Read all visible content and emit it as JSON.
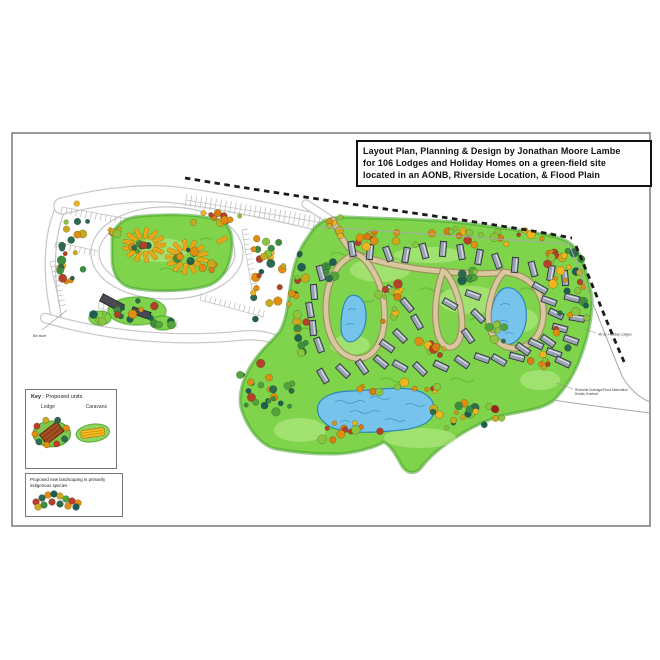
{
  "title_block": {
    "line1": "Layout Plan, Planning & Design by Jonathan Moore Lambe",
    "line2": "for 106 Lodges and Holiday Homes on a green-field site",
    "line3": "located in an AONB, Riverside Location, & Flood Plain"
  },
  "legend": {
    "key_word": "Key",
    "units_title": " : Proposed units",
    "lodge_label": "Lodge",
    "caravans_label": "Caravans",
    "landscaping_line1": "Proposed new landscaping in primarily",
    "landscaping_line2": "indigenous species"
  },
  "annotations": [
    {
      "name": "holiday-lodges-count-note",
      "text": "46 no. Holiday Lodges",
      "x": 598,
      "y": 335.5,
      "fs": 3.4,
      "leader": [
        584,
        329,
        596,
        333
      ]
    },
    {
      "name": "drainage-note",
      "text": "Riverside Drainage/Flood Attenuation",
      "text2": "Details Overleaf",
      "x": 575,
      "y": 391,
      "fs": 3.2,
      "leader": [
        556,
        383,
        573,
        389
      ]
    },
    {
      "name": "bin-store-note",
      "text": "Bin store",
      "x": 33,
      "y": 337,
      "fs": 3.4,
      "leader": [
        67,
        310,
        42,
        330
      ]
    }
  ],
  "colors": {
    "green_base": "#7fd44c",
    "green_edge": "#46a22c",
    "green_light": "#bdeb8e",
    "squiggle": "#4ea32d",
    "pond_fill": "#76c4ec",
    "pond_edge": "#2e86b8",
    "wave": "#3f98cc",
    "road_tan": "#d8c79f",
    "road_tan_edge": "#a08b62",
    "road_white_edge": "#c6c6c6",
    "lodge_fill": "#99a2b0",
    "lodge_edge": "#30343c",
    "lodge_ridge": "#e8edf4",
    "caravan_fill": "#f2c11d",
    "caravan_edge": "#b67a16",
    "caravan_stripe": "#d88f15",
    "building": "#4a4a52",
    "dash": "#1c1c1c",
    "thin": "#a8a8a8",
    "tree_stroke": "rgba(35,50,10,0.45)",
    "note_text": "#3a3a3a",
    "leader": "#999999",
    "sheet_border": "#7a7a7a"
  },
  "palettes": {
    "mixed": [
      "#e08e12",
      "#f0b41c",
      "#8bc53f",
      "#3e8e41",
      "#2d6a4f",
      "#b5402a",
      "#caa91f",
      "#1f5e52"
    ],
    "warm": [
      "#e08e12",
      "#f0b41c",
      "#d97b12",
      "#b5402a",
      "#caa91f",
      "#8bc53f",
      "#e08e12"
    ],
    "greens": [
      "#3e8e41",
      "#2d6a4f",
      "#52a33c",
      "#8bc53f",
      "#1f5e52"
    ],
    "dark": [
      "#2d6a4f",
      "#1f5e52",
      "#3e8e41",
      "#b5402a",
      "#e08e12",
      "#52a33c"
    ]
  },
  "map": {
    "sheet": {
      "x": 12,
      "y": 133,
      "w": 638,
      "h": 393
    },
    "white_roads": [
      {
        "d": "M95,253 C95,229 127,211 167,211 C207,211 239,229 239,253 C239,277 207,295 167,295 C127,295 95,277 95,253 Z",
        "w": 7
      },
      {
        "d": "M56,315 C46,270 50,228 62,206",
        "w": 9
      },
      {
        "d": "M62,206 C110,194 150,192 176,195 C230,202 285,214 334,226",
        "w": 15
      },
      {
        "d": "M45,318 C95,333 165,343 238,336 C268,332 288,343 298,357",
        "w": 8
      },
      {
        "d": "M306,204 C315,210 325,216 333,222",
        "w": 7
      }
    ],
    "parking_rows": [
      {
        "x1": 186,
        "y1": 200,
        "x2": 330,
        "y2": 224,
        "len": 6,
        "step": 5,
        "side": 0
      },
      {
        "x1": 62,
        "y1": 207,
        "x2": 146,
        "y2": 222,
        "len": 6.5,
        "step": 5,
        "side": 1
      },
      {
        "x1": 56,
        "y1": 242,
        "x2": 98,
        "y2": 251,
        "len": 6,
        "step": 5,
        "side": 1
      },
      {
        "x1": 50,
        "y1": 262,
        "x2": 60,
        "y2": 306,
        "len": 6,
        "step": 5,
        "side": -1
      },
      {
        "x1": 98,
        "y1": 308,
        "x2": 178,
        "y2": 327,
        "len": 6.5,
        "step": 5,
        "side": -1
      },
      {
        "x1": 200,
        "y1": 300,
        "x2": 264,
        "y2": 317,
        "len": 6.5,
        "step": 5,
        "side": -1
      },
      {
        "x1": 242,
        "y1": 230,
        "x2": 252,
        "y2": 290,
        "len": 6,
        "step": 5,
        "side": -1
      }
    ],
    "site_blob": "M312,231 C318,222 330,217 345,217 C390,219 440,219 480,225 C515,230 545,233 562,239 C572,242 580,252 584,266 C589,282 592,294 592,301 C592,316 589,334 581,356 C574,376 563,391 553,401 C540,410 522,411 505,415 C488,419 470,428 455,438 C445,445 432,453 420,469 C415,474 407,474 402,466 C397,457 392,447 384,442 C374,448 352,454 333,454 C315,454 298,453 276,449 C262,446 249,431 242,411 C237,396 243,378 252,364 C262,348 273,341 280,331 C287,319 288,301 291,282 C294,263 300,248 306,240 Z",
    "caravan_blob": "M112,240 C112,226 124,217 142,216 C165,214 195,214 215,219 C228,222 233,232 232,245 C231,262 226,278 210,285 C190,292 150,292 132,288 C118,285 112,272 112,258 Z",
    "patches_green": [
      [
        137,
        311,
        29,
        14
      ],
      [
        100,
        318,
        11,
        7
      ],
      [
        163,
        323,
        12,
        7
      ]
    ],
    "patches_light": [
      [
        380,
        270,
        30,
        12
      ],
      [
        470,
        300,
        32,
        14
      ],
      [
        350,
        345,
        20,
        10
      ],
      [
        520,
        320,
        18,
        12
      ],
      [
        420,
        438,
        36,
        10
      ],
      [
        300,
        430,
        26,
        12
      ],
      [
        430,
        255,
        36,
        8
      ],
      [
        160,
        250,
        28,
        12
      ],
      [
        540,
        380,
        20,
        10
      ]
    ],
    "squiggles": [
      "M330,255 q7,-5 14,0 t14,0",
      "M350,300 q6,-4 12,0 t12,0",
      "M420,290 q6,-4 12,0 t12,0",
      "M470,320 q6,-4 12,0 t12,0",
      "M520,290 q6,-4 12,0 t12,0",
      "M380,380 q6,-4 12,0 t12,0",
      "M450,380 q6,-4 12,0 t12,0",
      "M300,330 q5,-4 10,0 t10,0",
      "M130,235 q6,-4 12,0 t12,0",
      "M160,270 q6,-4 12,0 t12,0",
      "M200,240 q6,-4 12,0",
      "M330,430 q6,-4 12,0 t12,0",
      "M490,360 q6,-4 12,0"
    ],
    "ponds": [
      "M350,296 C358,293 365,300 366,312 C367,325 362,337 354,341 C347,344 341,338 341,327 C341,315 343,300 350,296 Z",
      "M505,288 C515,286 524,295 526,309 C528,325 522,340 511,344 C501,347 492,339 491,324 C490,309 495,291 505,288 Z",
      "M318,405 C322,396 335,391 352,391 C375,390 400,386 415,390 C428,393 436,402 434,412 C432,422 420,428 402,430 C382,432 358,434 340,430 C326,427 315,417 318,405 Z"
    ],
    "waves": [
      "M335,402 q5,-3 10,0 q5,3 10,0 q5,-3 10,0",
      "M350,412 q5,-3 10,0 q5,3 10,0 q5,-3 10,0",
      "M370,398 q5,-3 10,0 q5,3 10,0",
      "M385,420 q5,-3 10,0 q5,3 10,0",
      "M340,422 q5,-3 10,0",
      "M405,405 q5,-3 10,0 q5,3 10,0",
      "M348,310 q4,-3 8,0",
      "M346,325 q4,-3 8,0",
      "M500,305 q5,-3 10,0",
      "M498,322 q5,-3 10,0",
      "M505,334 q4,-3 8,0"
    ],
    "tan_roads": [
      "M333,220 C340,235 345,246 356,254 C385,265 420,270 450,272 C478,274 492,274 504,272",
      "M356,254 C338,260 327,280 326,304 C325,330 334,351 350,357 C367,363 379,350 383,331 C387,310 383,288 374,273 C368,262 362,256 356,254 Z",
      "M443,271 C437,288 433,310 437,330 C440,348 453,353 459,340 C465,327 461,304 455,289 C451,279 446,272 443,271 Z",
      "M504,272 C532,275 546,295 543,319 C540,341 523,352 507,347 C492,342 486,325 489,307 C492,291 497,279 504,272 Z"
    ],
    "buildings": [
      {
        "x": 112,
        "y": 303,
        "w": 24,
        "h": 8,
        "r": 28
      },
      {
        "x": 141,
        "y": 313,
        "w": 19,
        "h": 7,
        "r": 18
      }
    ],
    "lodges": [
      [
        352,
        249,
        80
      ],
      [
        370,
        252,
        95
      ],
      [
        388,
        254,
        70
      ],
      [
        406,
        255,
        100
      ],
      [
        424,
        251,
        75
      ],
      [
        443,
        249,
        95
      ],
      [
        461,
        252,
        80
      ],
      [
        479,
        257,
        100
      ],
      [
        497,
        261,
        70
      ],
      [
        515,
        265,
        95
      ],
      [
        533,
        269,
        75
      ],
      [
        551,
        273,
        100
      ],
      [
        565,
        278,
        85
      ],
      [
        540,
        288,
        30
      ],
      [
        549,
        301,
        20
      ],
      [
        556,
        314,
        25
      ],
      [
        560,
        328,
        15
      ],
      [
        548,
        341,
        35
      ],
      [
        554,
        353,
        20
      ],
      [
        572,
        298,
        15
      ],
      [
        577,
        318,
        10
      ],
      [
        571,
        340,
        20
      ],
      [
        563,
        362,
        25
      ],
      [
        323,
        376,
        60
      ],
      [
        343,
        371,
        45
      ],
      [
        362,
        367,
        55
      ],
      [
        381,
        362,
        40
      ],
      [
        400,
        366,
        30
      ],
      [
        420,
        369,
        45
      ],
      [
        441,
        366,
        25
      ],
      [
        462,
        362,
        35
      ],
      [
        482,
        358,
        20
      ],
      [
        499,
        360,
        30
      ],
      [
        517,
        357,
        15
      ],
      [
        321,
        273,
        75
      ],
      [
        314,
        292,
        85
      ],
      [
        310,
        310,
        80
      ],
      [
        313,
        328,
        85
      ],
      [
        319,
        345,
        70
      ],
      [
        393,
        291,
        30
      ],
      [
        407,
        305,
        50
      ],
      [
        417,
        322,
        60
      ],
      [
        400,
        336,
        45
      ],
      [
        387,
        346,
        35
      ],
      [
        450,
        304,
        30
      ],
      [
        473,
        295,
        20
      ],
      [
        478,
        316,
        45
      ],
      [
        468,
        336,
        55
      ],
      [
        523,
        349,
        35
      ],
      [
        536,
        344,
        25
      ]
    ],
    "caravan_rings": [
      {
        "cx": 144,
        "cy": 245,
        "rx": 16,
        "ry": 12,
        "n": 13,
        "a0": 0
      },
      {
        "cx": 187,
        "cy": 257,
        "rx": 16,
        "ry": 12,
        "n": 13,
        "a0": 14
      }
    ],
    "caravan_singles": [
      [
        113,
        232,
        40
      ],
      [
        222,
        240,
        150
      ]
    ],
    "tree_clusters": [
      [
        78,
        248,
        22,
        45,
        22,
        "mixed",
        11
      ],
      [
        216,
        216,
        36,
        9,
        12,
        "warm",
        22
      ],
      [
        338,
        224,
        10,
        7,
        5,
        "warm",
        33
      ],
      [
        266,
        277,
        18,
        52,
        26,
        "mixed",
        44
      ],
      [
        143,
        244,
        12,
        9,
        8,
        "dark",
        55
      ],
      [
        186,
        256,
        12,
        9,
        8,
        "dark",
        56
      ],
      [
        120,
        232,
        11,
        6,
        4,
        "warm",
        57
      ],
      [
        210,
        268,
        9,
        6,
        4,
        "warm",
        58
      ],
      [
        137,
        310,
        26,
        13,
        10,
        "dark",
        59
      ],
      [
        100,
        318,
        10,
        6,
        4,
        "greens",
        60
      ],
      [
        455,
        237,
        105,
        9,
        26,
        "warm",
        61
      ],
      [
        360,
        240,
        28,
        7,
        7,
        "warm",
        62
      ],
      [
        570,
        300,
        19,
        52,
        24,
        "mixed",
        63
      ],
      [
        545,
        258,
        12,
        8,
        7,
        "warm",
        64
      ],
      [
        300,
        302,
        13,
        52,
        20,
        "mixed",
        65
      ],
      [
        268,
        388,
        32,
        27,
        24,
        "dark",
        66
      ],
      [
        350,
        432,
        46,
        10,
        12,
        "warm",
        67
      ],
      [
        466,
        416,
        36,
        17,
        20,
        "mixed",
        68
      ],
      [
        390,
        305,
        15,
        26,
        12,
        "warm",
        69
      ],
      [
        430,
        350,
        15,
        13,
        9,
        "warm",
        70
      ],
      [
        497,
        330,
        11,
        15,
        8,
        "greens",
        71
      ],
      [
        540,
        360,
        11,
        11,
        7,
        "warm",
        72
      ],
      [
        405,
        390,
        52,
        8,
        12,
        "warm",
        73
      ],
      [
        330,
        270,
        9,
        9,
        6,
        "greens",
        74
      ],
      [
        470,
        277,
        13,
        7,
        6,
        "greens",
        75
      ],
      [
        163,
        322,
        11,
        6,
        4,
        "greens",
        76
      ]
    ],
    "solo_trees": [
      [
        495,
        409,
        3.8,
        "#a32020"
      ],
      [
        580,
        282,
        3,
        "#b5402a"
      ],
      [
        433,
        412,
        3,
        "#2d6a4f"
      ]
    ],
    "dash_lines": [
      "M185,178 C250,189 330,201 420,214 C470,221 530,230 572,238",
      "M576,246 C590,278 607,324 626,366"
    ],
    "thin_lines": [
      "M320,227 C420,233 510,240 566,244",
      "M568,242 C585,282 603,330 622,376 C630,390 640,398 650,402",
      "M553,400 C585,405 620,409 650,413"
    ]
  }
}
